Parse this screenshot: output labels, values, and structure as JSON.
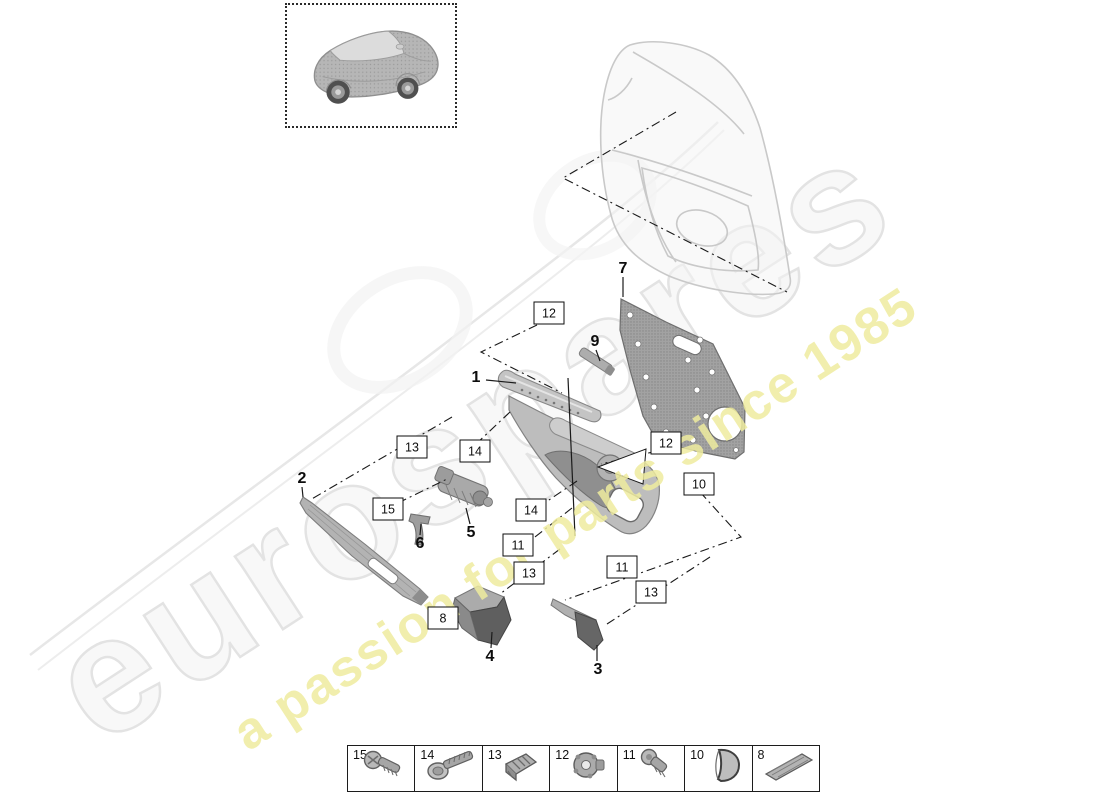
{
  "diagram_type": "exploded-parts-diagram",
  "subject": "rear door trim panel",
  "watermark": {
    "brand": "eurospares",
    "tagline": "a passion for parts since 1985",
    "brand_fill": "#f8f8f8",
    "brand_outline": "#e3e3e3",
    "tagline_color": "#efec9f"
  },
  "callouts": {
    "plain": [
      "1",
      "2",
      "3",
      "4",
      "5",
      "6",
      "7",
      "9"
    ],
    "boxed": [
      "12",
      "13",
      "14",
      "15",
      "14",
      "12",
      "10",
      "11",
      "13",
      "11",
      "13",
      "8"
    ]
  },
  "legend": {
    "items": [
      {
        "label": "15",
        "icon": "pan-head-screw-icon"
      },
      {
        "label": "14",
        "icon": "washer-head-screw-icon"
      },
      {
        "label": "13",
        "icon": "spring-clip-icon"
      },
      {
        "label": "12",
        "icon": "grommet-nut-icon"
      },
      {
        "label": "11",
        "icon": "short-screw-icon"
      },
      {
        "label": "10",
        "icon": "trim-cap-icon"
      },
      {
        "label": "8",
        "icon": "trim-strip-icon"
      }
    ]
  },
  "colors": {
    "line": "#1a1a1a",
    "part_light": "#c2c2c2",
    "part_mid": "#a0a0a0",
    "part_dark": "#5f5f5f",
    "ghost": "#c9c9c9"
  }
}
